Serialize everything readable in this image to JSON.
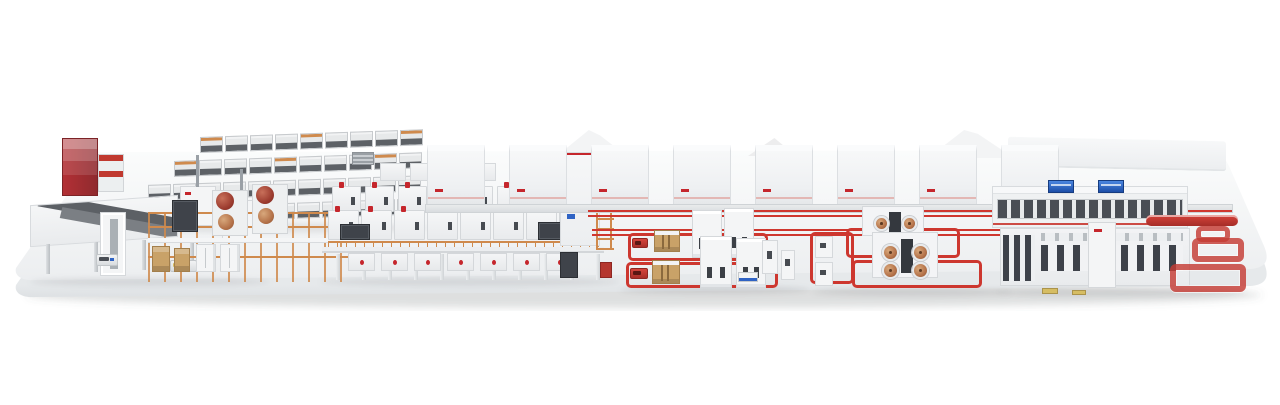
{
  "meta": {
    "description": "Isometric 3D rendering of a complete end-to-end industrial production line displayed on a white rounded platform",
    "background": "#ffffff",
    "visible_text": "none"
  },
  "palette": {
    "accent_red": "#c5262c",
    "bright_red": "#cf372f",
    "loop_red": "#c43c34",
    "scaffold_orange": "#cf8a4d",
    "wood": "#c9a268",
    "copper": "#b5734a",
    "dark_panel": "#3f434a",
    "steel_gray": "#9aa0a6",
    "screen_blue": "#2f63c4",
    "pallet_yellow": "#d6bd63",
    "platform_top_light": "#fbfcfc",
    "platform_top_dark": "#ebedef",
    "platform_side_light": "#e6e9eb",
    "platform_side_dark": "#d0d4d8",
    "machine_white": "#f4f5f6"
  },
  "scene": {
    "platform": {
      "name": "display-platform"
    },
    "sections": {
      "storage_racks": {
        "rows": 4,
        "cells_per_row": [
          9,
          10,
          11,
          12
        ],
        "orange_cap_every": 4
      },
      "intake": {
        "agvs": 2,
        "gantries": 2,
        "table_legs": 4
      },
      "mixing_mezzanine": {
        "roll_stands": 2,
        "rolls_per_stand": 2,
        "crates": 2,
        "cabinets": 2
      },
      "coating_line": {
        "back_modules": 8,
        "front_modules": 8,
        "under_modules": 7,
        "support_columns": 11,
        "rooftop_units": 4
      },
      "formation_cabinet_row": {
        "cabinets": 8
      },
      "assembly_loop_cluster": {
        "loops": 2,
        "tower_machines": 4,
        "red_agvs": 2,
        "robot_stations": 2,
        "side_machines": 2
      },
      "winding_cluster": {
        "loops": 3,
        "coils_back": 2,
        "coils_front": 4,
        "aux_machines": 2
      },
      "inspection_corridor": {
        "screens": 2
      },
      "pack_assembly_line": {
        "pallets": 2
      },
      "logistics_conveyor": {
        "serpentine_loops": 3,
        "red_bars": 1
      }
    }
  }
}
